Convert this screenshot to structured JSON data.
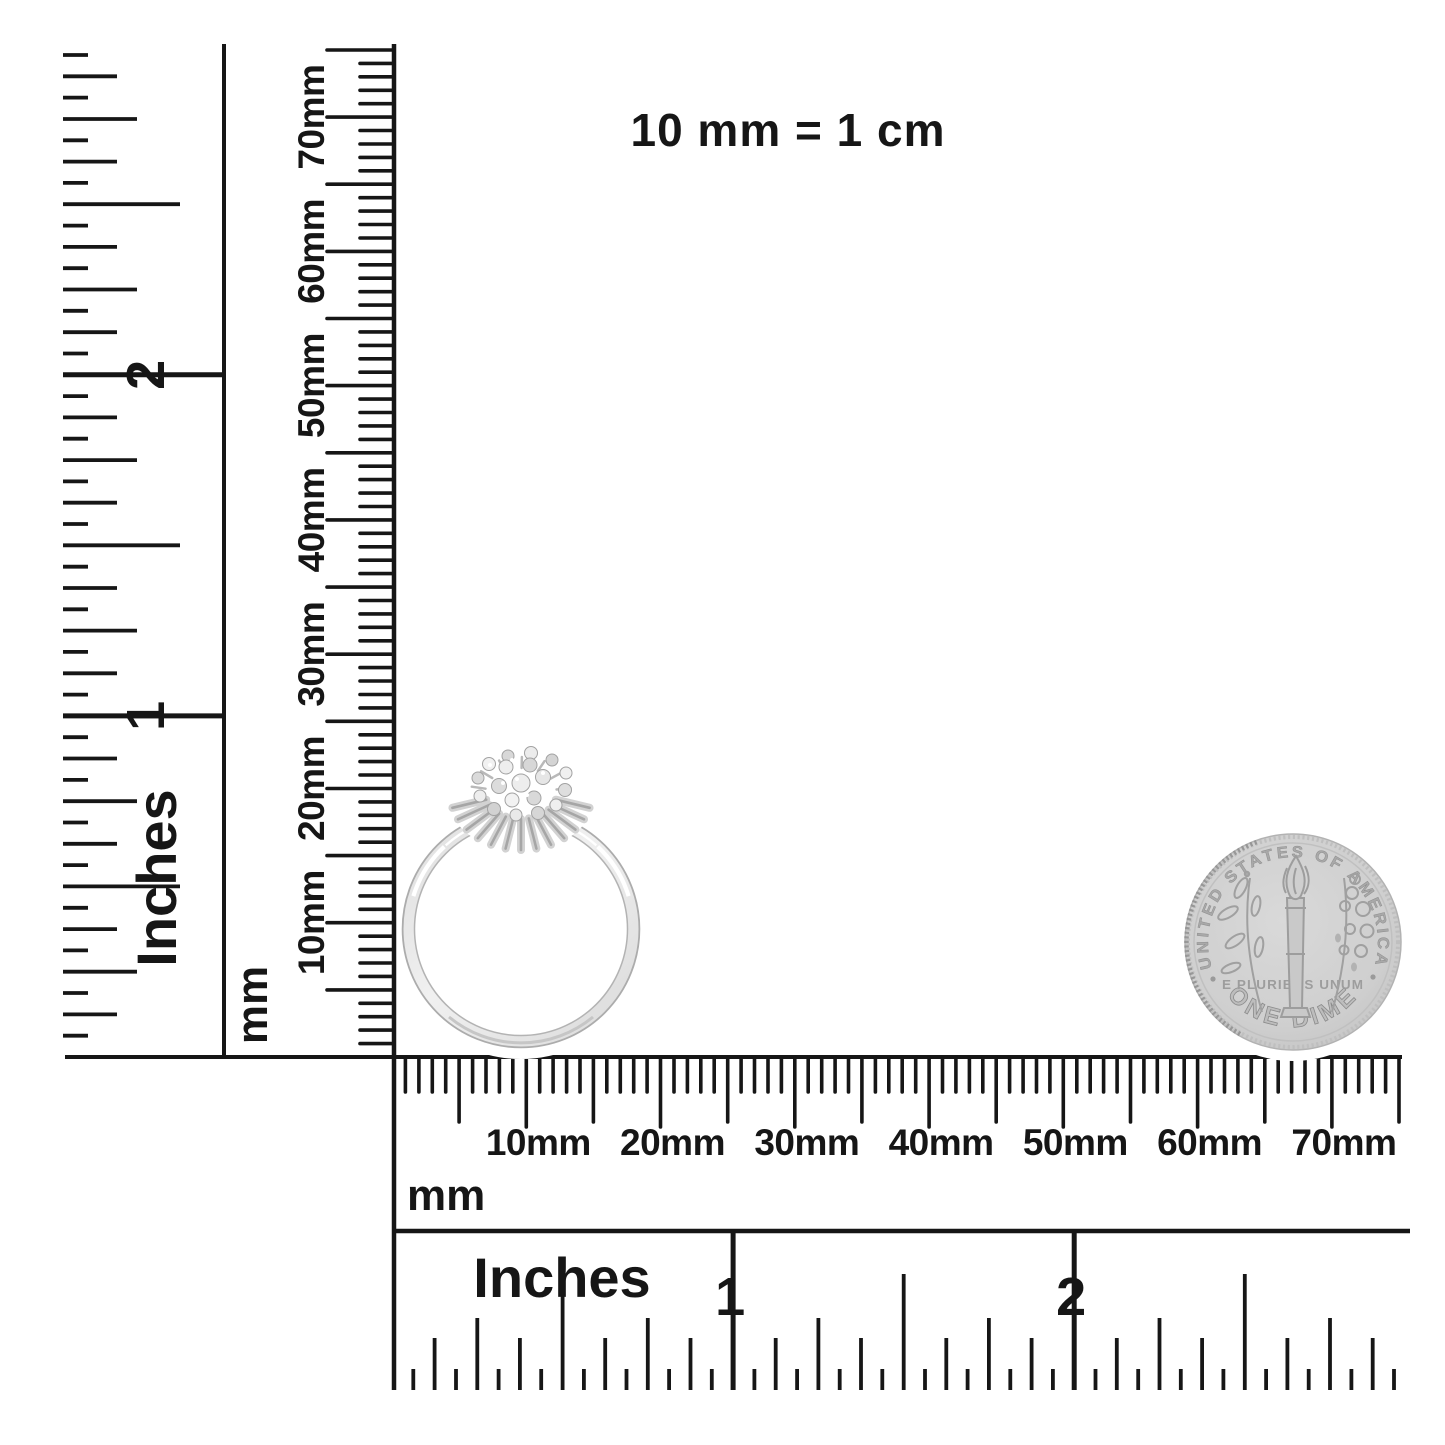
{
  "colors": {
    "ink": "#161616",
    "background": "#ffffff",
    "coin_gray": "#cdcdcd",
    "coin_relief": "#9e9e9e",
    "metal_light": "#e6e6e6",
    "metal_edge": "#aeaeae"
  },
  "note": {
    "text": "10 mm = 1 cm"
  },
  "rulers": {
    "left_inches": {
      "unit": "Inches",
      "numbers": [
        "1",
        "2"
      ]
    },
    "left_mm": {
      "unit": "mm",
      "labels": [
        "10mm",
        "20mm",
        "30mm",
        "40mm",
        "50mm",
        "60mm",
        "70mm"
      ]
    },
    "bottom_mm": {
      "unit": "mm",
      "labels": [
        "10mm",
        "20mm",
        "30mm",
        "40mm",
        "50mm",
        "60mm",
        "70mm"
      ]
    },
    "bottom_inches": {
      "unit": "Inches",
      "numbers": [
        "1",
        "2"
      ]
    }
  },
  "coin": {
    "top_text": "UNITED STATES OF AMERICA",
    "motto_text": "E PLURIBUS UNUM",
    "bottom_text": "ONE DIME"
  }
}
